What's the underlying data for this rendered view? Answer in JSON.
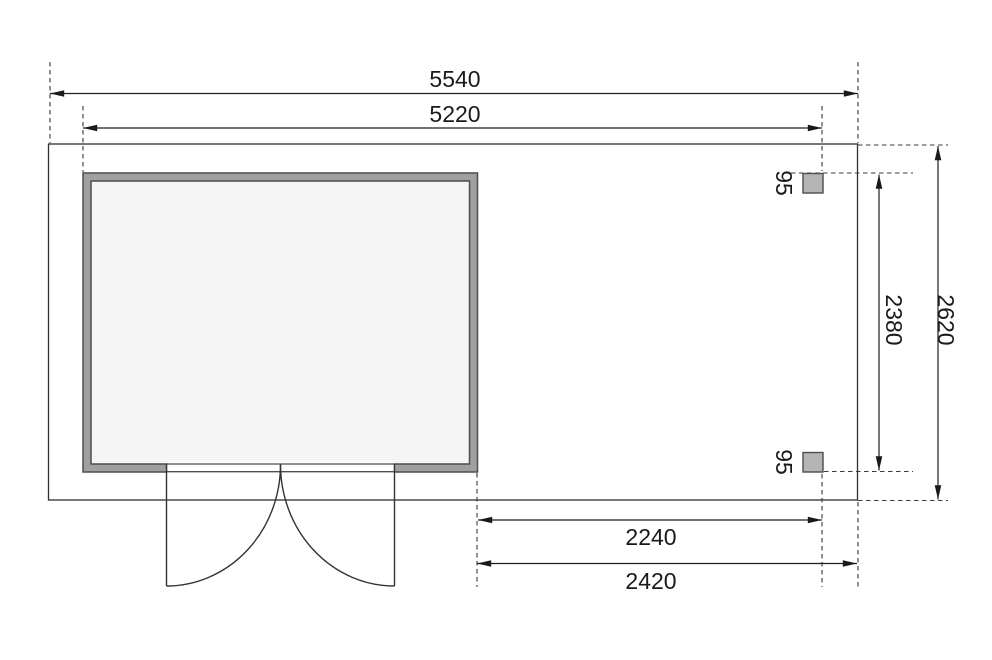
{
  "plan": {
    "dims": {
      "overall_width": "5540",
      "body_width": "5220",
      "overall_depth": "2620",
      "post_inner_depth": "2380",
      "annex_inner_width": "2240",
      "annex_overall_width": "2420",
      "post_top_size": "95",
      "post_bottom_size": "95"
    },
    "colors": {
      "background": "#ffffff",
      "dimension_line": "#2a2a2a",
      "extension_dash": "#3a3a3a",
      "wall_fill": "#a0a0a0",
      "wall_outline": "#4d4d4d",
      "interior_fill": "#f5f5f5",
      "post_fill": "#b5b5b5",
      "text": "#1a1a1a"
    }
  }
}
